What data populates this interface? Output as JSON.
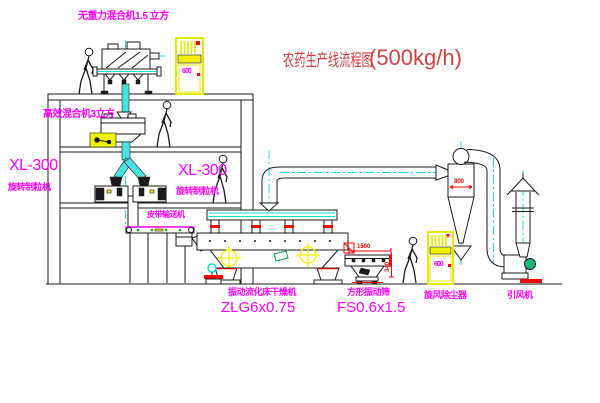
{
  "title": {
    "text": "农药生产线流程图",
    "capacity": "(500kg/h)"
  },
  "equipment_labels": {
    "gravity_mixer": "无重力混合机1.5 立方",
    "high_efficiency_mixer": "高效混合机3立方",
    "granulator_left": {
      "model": "XL-300",
      "name": "旋转制粒机"
    },
    "granulator_right": {
      "model": "XL-300",
      "name": "旋转制粒机"
    },
    "belt_conveyor": "皮带输送机",
    "dryer": {
      "name": "振动流化床干燥机",
      "model": "ZLG6x0.75"
    },
    "sieve": {
      "name": "方形振动筛",
      "model": "FS0.6x1.5"
    },
    "cyclone": "旋风除尘器",
    "fan": "引风机"
  },
  "dimensions": {
    "sieve_length": "1500",
    "sieve_outlet_height": "340",
    "cyclone_inlet": "800"
  },
  "control_cabinets": {
    "cabinet_1": "600",
    "cabinet_2": "600"
  },
  "colors": {
    "label_magenta": "#ff00ff",
    "title_red": "#cd3b3b",
    "line_black": "#1a1a1a",
    "centerline_cyan": "#00dede",
    "cabinet_yellow": "#f2f200",
    "dimension_red": "#ff0000"
  }
}
